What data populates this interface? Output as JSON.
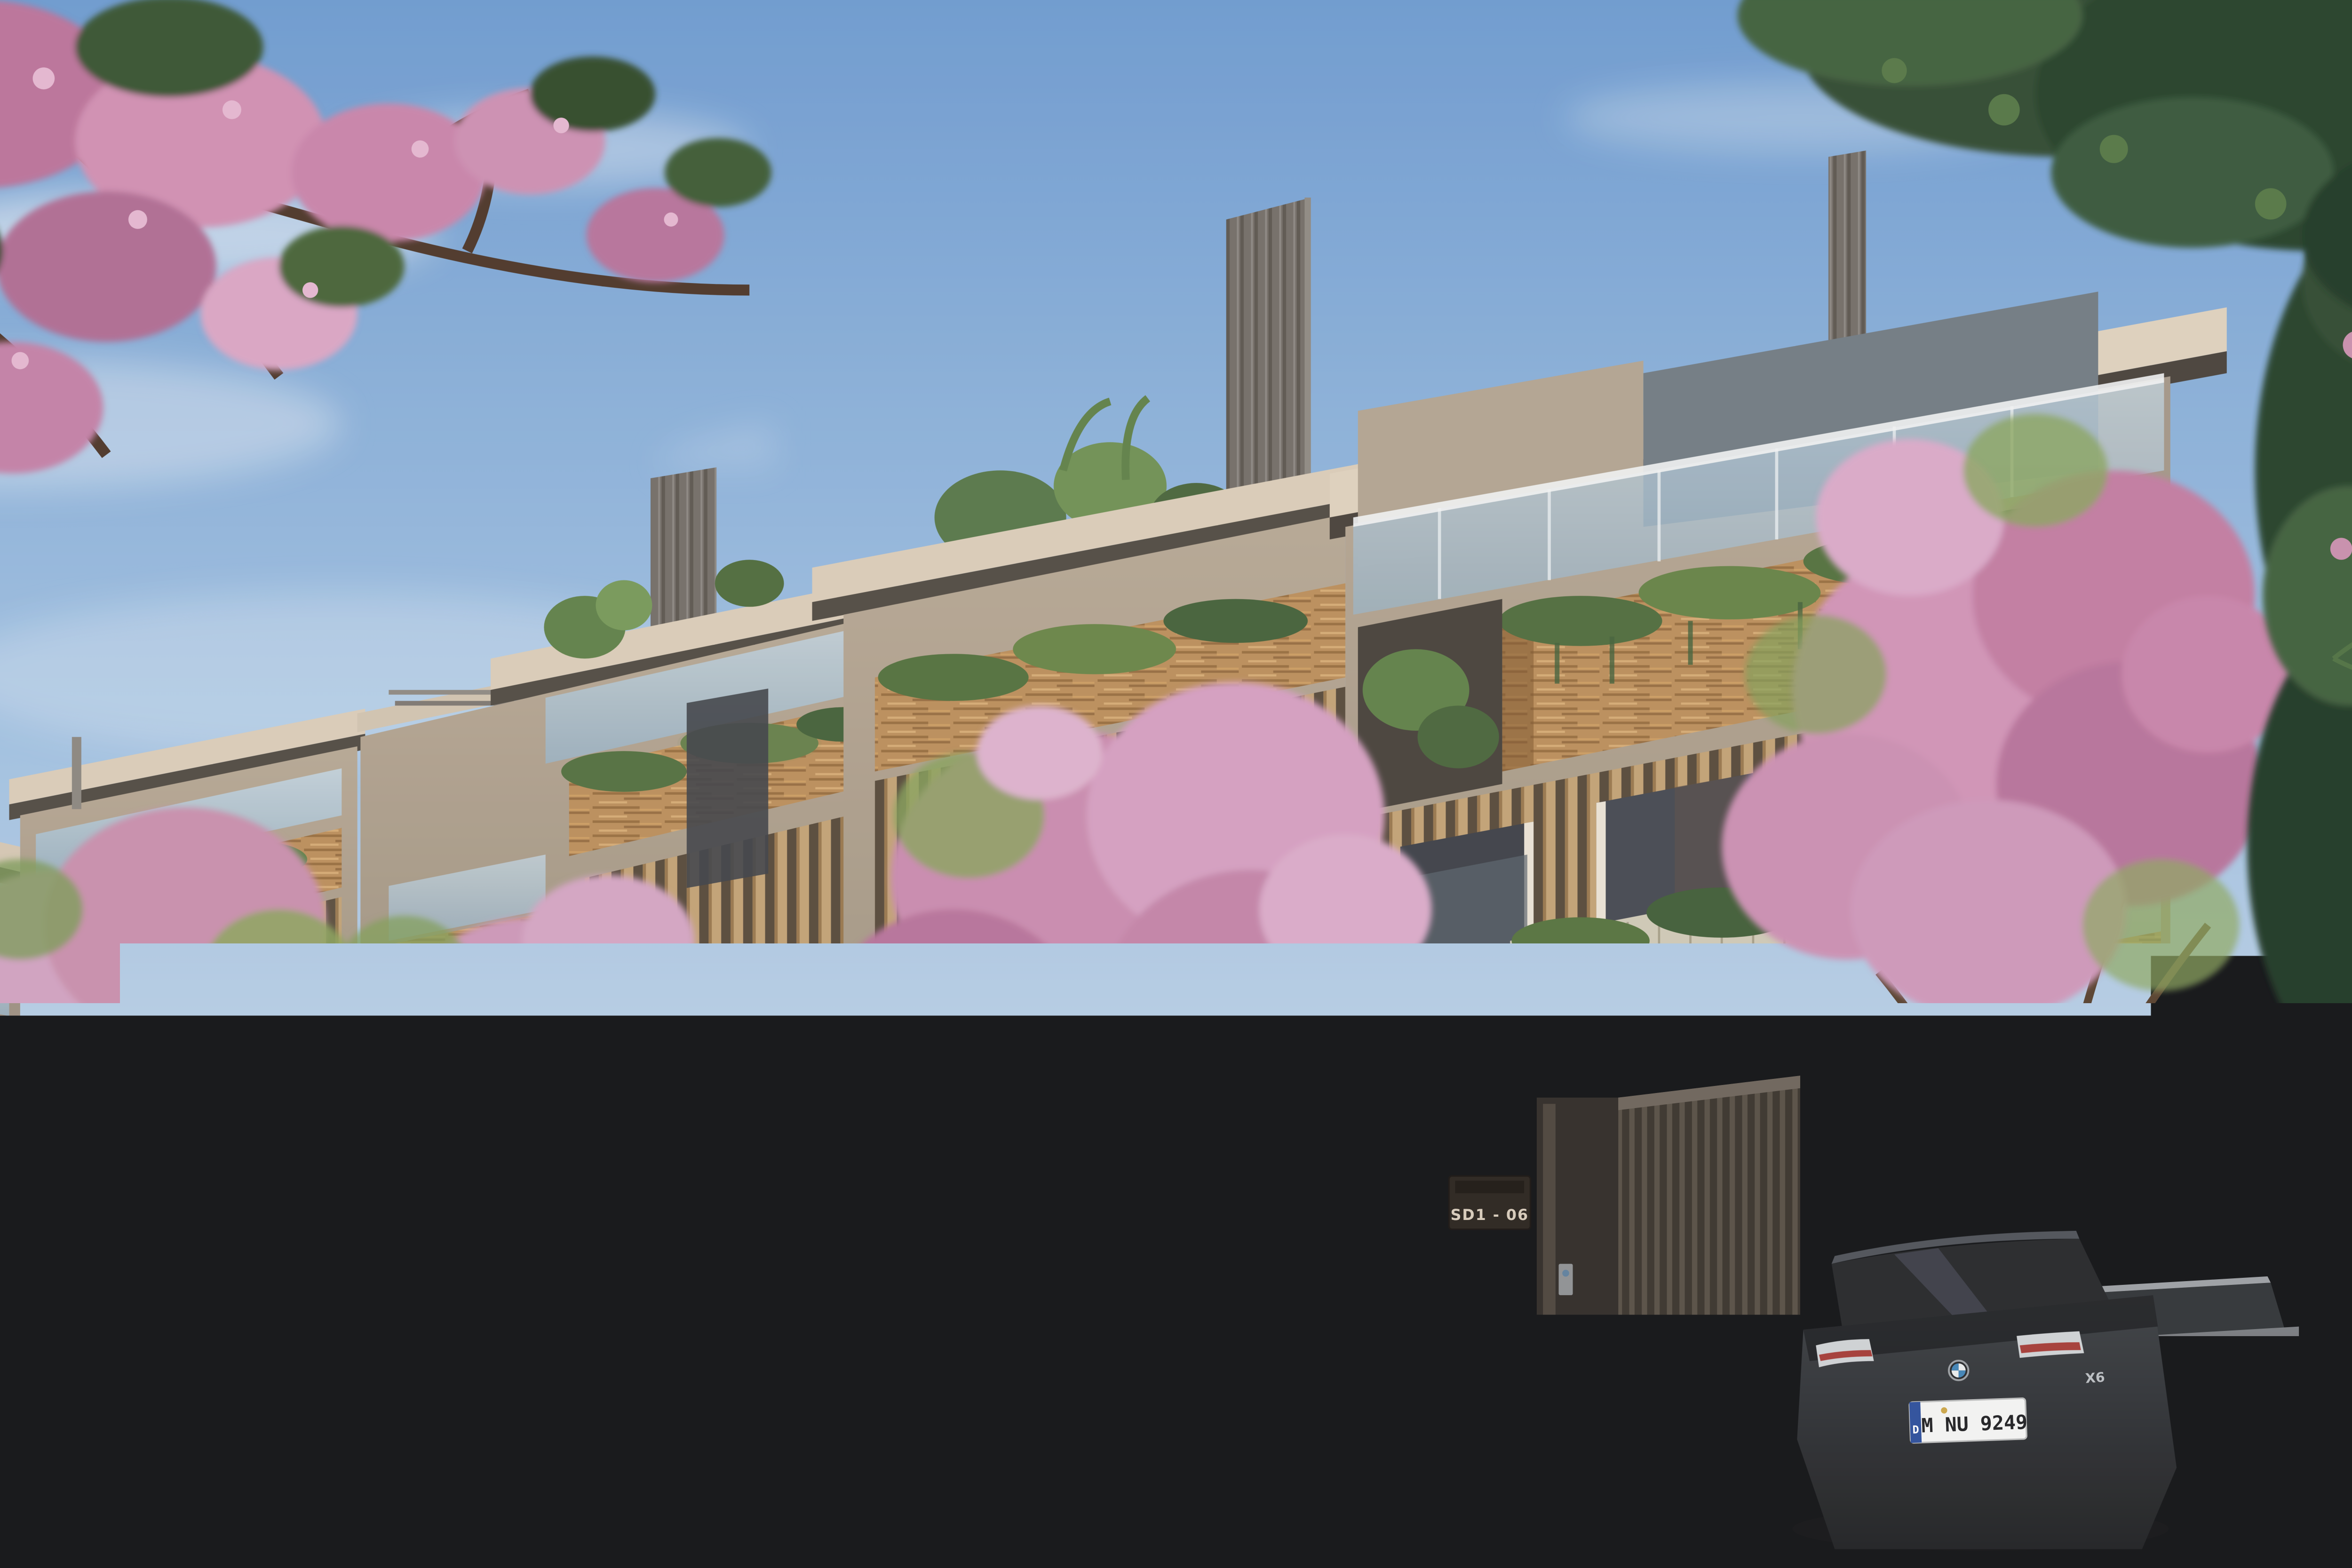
{
  "scene": {
    "title": "Street-level architectural render of modern tropical townhouses with wood louvers, roof terraces, flowering trees and parked cars"
  },
  "palette": {
    "sky_top": "#6b9ad1",
    "sky_mid": "#9dbfe2",
    "sky_horizon": "#dce6ee",
    "stucco_light": "#b5a896",
    "stucco_shadow": "#8e8376",
    "roof_fascia": "#d8ccba",
    "wood_light": "#c59a66",
    "wood_dark": "#8a6238",
    "louver_tan": "#bf9c70",
    "fin_gray": "#716d69",
    "glass_blue": "#a9c4d9",
    "foliage_dark": "#2d4a30",
    "foliage_light": "#7da05c",
    "blossom_pink": "#cb8fb4",
    "blossom_deep": "#ad6c94",
    "fence_dark": "#3e3933",
    "screen_light": "#c3c6c8",
    "road_asphalt": "#4c5056",
    "sidewalk": "#b3a694",
    "car_charcoal": "#2d3034",
    "car_gray": "#6d7176"
  },
  "signage": {
    "gate_sign": "SD1 - 06"
  },
  "vehicles": {
    "bmw_suv": {
      "make": "BMW",
      "badge": "X6",
      "license_plate": "M NU 9249",
      "plate_country": "D"
    },
    "audi_sedan": {
      "make": "Audi",
      "badge": "A8",
      "license_plate": "M NU 9249",
      "plate_country": "D"
    }
  },
  "figures": {
    "pedestrians": 2
  },
  "environment": {
    "blossom_trees": 5,
    "moving_vehicles": 1,
    "lane_marking": "dashed-white"
  }
}
